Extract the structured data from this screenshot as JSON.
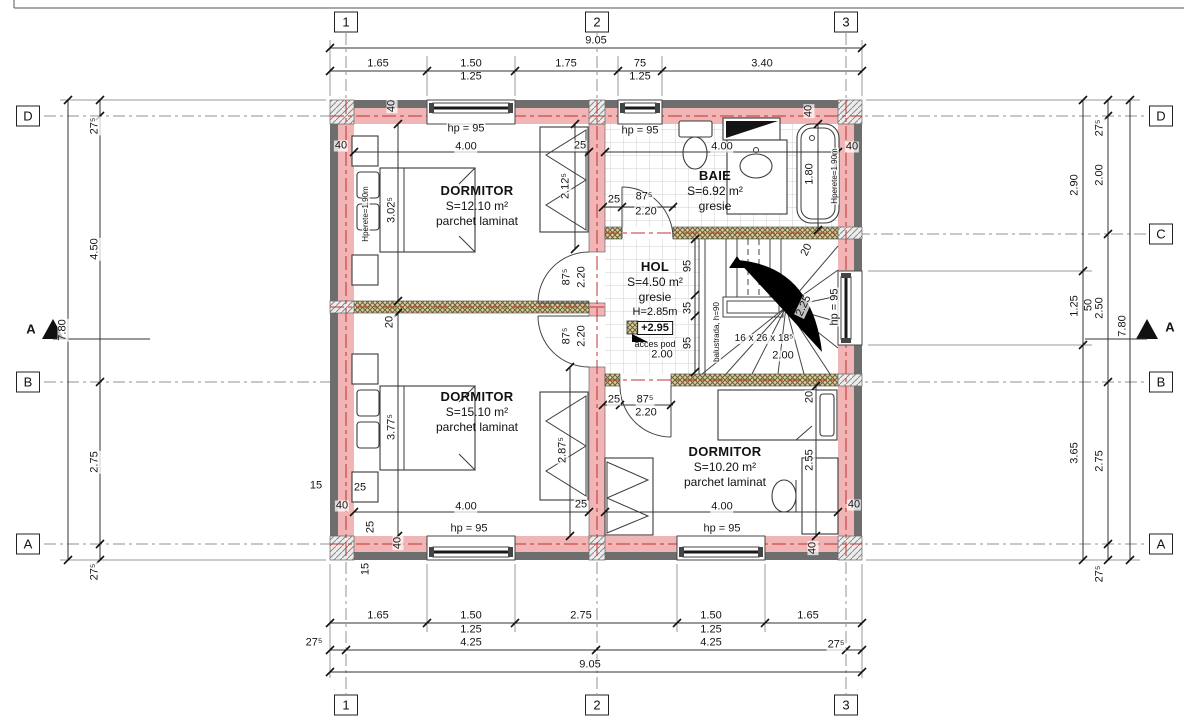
{
  "colors": {
    "wall_pink": "#f2b5b5",
    "wall_gray": "#6e6e6e",
    "axis_red": "#c03030",
    "hatch_bg": "#d8cf9f",
    "hatch_line": "#6b6136"
  },
  "rooms": [
    {
      "name": "DORMITOR",
      "area": "S=12.10 m²",
      "finish": "parchet laminat"
    },
    {
      "name": "BAIE",
      "area": "S=6.92 m²",
      "finish": "gresie"
    },
    {
      "name": "HOL",
      "area": "S=4.50 m²",
      "finish": "gresie",
      "height": "H=2.85m",
      "level": "+2.95",
      "note": "acces pod"
    },
    {
      "name": "DORMITOR",
      "area": "S=15.10 m²",
      "finish": "parchet laminat"
    },
    {
      "name": "DORMITOR",
      "area": "S=10.20 m²",
      "finish": "parchet laminat"
    }
  ],
  "grid": {
    "bubbles": [
      {
        "label": "1",
        "x": 346,
        "y": 22
      },
      {
        "label": "2",
        "x": 597,
        "y": 22
      },
      {
        "label": "3",
        "x": 846,
        "y": 22
      },
      {
        "label": "1",
        "x": 346,
        "y": 705
      },
      {
        "label": "2",
        "x": 597,
        "y": 705
      },
      {
        "label": "3",
        "x": 846,
        "y": 705
      },
      {
        "label": "D",
        "x": 28,
        "y": 116
      },
      {
        "label": "B",
        "x": 28,
        "y": 382
      },
      {
        "label": "A",
        "x": 28,
        "y": 544
      },
      {
        "label": "D",
        "x": 1161,
        "y": 116
      },
      {
        "label": "C",
        "x": 1161,
        "y": 234
      },
      {
        "label": "B",
        "x": 1161,
        "y": 382
      },
      {
        "label": "A",
        "x": 1161,
        "y": 544
      }
    ]
  },
  "dims": [
    {
      "t": "9.05",
      "x": 596,
      "y": 41
    },
    {
      "t": "1.65",
      "x": 378,
      "y": 64
    },
    {
      "t": "1.50",
      "x": 471,
      "y": 64
    },
    {
      "t": "1.25",
      "x": 471,
      "y": 77
    },
    {
      "t": "1.75",
      "x": 566,
      "y": 64
    },
    {
      "t": "75",
      "x": 640,
      "y": 64
    },
    {
      "t": "1.25",
      "x": 640,
      "y": 77
    },
    {
      "t": "3.40",
      "x": 762,
      "y": 64
    },
    {
      "t": "1.65",
      "x": 378,
      "y": 616
    },
    {
      "t": "1.50",
      "x": 471,
      "y": 616
    },
    {
      "t": "1.25",
      "x": 471,
      "y": 630
    },
    {
      "t": "2.75",
      "x": 581,
      "y": 616
    },
    {
      "t": "1.50",
      "x": 711,
      "y": 616
    },
    {
      "t": "1.25",
      "x": 711,
      "y": 630
    },
    {
      "t": "1.65",
      "x": 808,
      "y": 616
    },
    {
      "t": "27⁵",
      "x": 314,
      "y": 643
    },
    {
      "t": "4.25",
      "x": 471,
      "y": 643
    },
    {
      "t": "4.25",
      "x": 711,
      "y": 643
    },
    {
      "t": "27⁵",
      "x": 836,
      "y": 645
    },
    {
      "t": "9.05",
      "x": 590,
      "y": 665
    },
    {
      "t": "7.80",
      "x": 63,
      "y": 330,
      "r": -90
    },
    {
      "t": "27⁵",
      "x": 95,
      "y": 126,
      "r": -90
    },
    {
      "t": "4.50",
      "x": 95,
      "y": 249,
      "r": -90
    },
    {
      "t": "2.75",
      "x": 95,
      "y": 462,
      "r": -90
    },
    {
      "t": "27⁵",
      "x": 95,
      "y": 572,
      "r": -90
    },
    {
      "t": "A",
      "x": 31,
      "y": 329,
      "b": 1,
      "n": "section-marker-label"
    },
    {
      "t": "27⁵",
      "x": 1100,
      "y": 128,
      "r": -90
    },
    {
      "t": "2.00",
      "x": 1100,
      "y": 175,
      "r": -90
    },
    {
      "t": "2.90",
      "x": 1075,
      "y": 185,
      "r": -90
    },
    {
      "t": "1.25",
      "x": 1075,
      "y": 306,
      "r": -90
    },
    {
      "t": "50",
      "x": 1089,
      "y": 305,
      "r": -90
    },
    {
      "t": "2.50",
      "x": 1100,
      "y": 308,
      "r": -90
    },
    {
      "t": "7.80",
      "x": 1123,
      "y": 326,
      "r": -90
    },
    {
      "t": "3.65",
      "x": 1075,
      "y": 453,
      "r": -90
    },
    {
      "t": "2.75",
      "x": 1100,
      "y": 461,
      "r": -90
    },
    {
      "t": "27⁵",
      "x": 1100,
      "y": 574,
      "r": -90
    },
    {
      "t": "A",
      "x": 1170,
      "y": 327,
      "b": 1,
      "n": "section-marker-label"
    },
    {
      "t": "hp = 95",
      "x": 466,
      "y": 129
    },
    {
      "t": "4.00",
      "x": 466,
      "y": 147
    },
    {
      "t": "40",
      "x": 341,
      "y": 146
    },
    {
      "t": "40",
      "x": 392,
      "y": 106,
      "r": -90
    },
    {
      "t": "25",
      "x": 580,
      "y": 146
    },
    {
      "t": "3.02⁵",
      "x": 392,
      "y": 210,
      "r": -90
    },
    {
      "t": "2.12⁵",
      "x": 566,
      "y": 186,
      "r": -90
    },
    {
      "t": "Hperete=1.90m",
      "x": 366,
      "y": 214,
      "r": -90,
      "s": 8
    },
    {
      "t": "20",
      "x": 390,
      "y": 322,
      "r": -90
    },
    {
      "t": "hp = 95",
      "x": 640,
      "y": 131
    },
    {
      "t": "4.00",
      "x": 722,
      "y": 147
    },
    {
      "t": "40",
      "x": 852,
      "y": 147
    },
    {
      "t": "40",
      "x": 809,
      "y": 111,
      "r": -90
    },
    {
      "t": "1.80",
      "x": 810,
      "y": 174,
      "r": -90
    },
    {
      "t": "Hperete=1.90m",
      "x": 835,
      "y": 176,
      "r": -90,
      "s": 8
    },
    {
      "t": "25",
      "x": 614,
      "y": 200
    },
    {
      "t": "87⁵",
      "x": 644,
      "y": 197
    },
    {
      "t": "2.20",
      "x": 646,
      "y": 212
    },
    {
      "t": "87⁵",
      "x": 567,
      "y": 277,
      "r": -90
    },
    {
      "t": "2.20",
      "x": 582,
      "y": 277,
      "r": -90
    },
    {
      "t": "87⁵",
      "x": 567,
      "y": 336,
      "r": -90
    },
    {
      "t": "2.20",
      "x": 582,
      "y": 336,
      "r": -90
    },
    {
      "t": "95",
      "x": 688,
      "y": 266,
      "r": -90
    },
    {
      "t": "35",
      "x": 688,
      "y": 308,
      "r": -90
    },
    {
      "t": "95",
      "x": 688,
      "y": 343,
      "r": -90
    },
    {
      "t": "2.00",
      "x": 662,
      "y": 355
    },
    {
      "t": "balustrada, h=90",
      "x": 717,
      "y": 332,
      "r": -90,
      "s": 8,
      "n": "stair-balustrade-label"
    },
    {
      "t": "16 x 26 x 18⁵",
      "x": 764,
      "y": 339,
      "s": 10,
      "n": "stair-formula"
    },
    {
      "t": "2.00",
      "x": 783,
      "y": 356
    },
    {
      "t": "2.25",
      "x": 804,
      "y": 306,
      "r": -65
    },
    {
      "t": "20",
      "x": 807,
      "y": 250,
      "r": -65
    },
    {
      "t": "hp = 95",
      "x": 835,
      "y": 307,
      "r": -90
    },
    {
      "t": "20",
      "x": 810,
      "y": 397,
      "r": -90
    },
    {
      "t": "2.55",
      "x": 810,
      "y": 460,
      "r": -90
    },
    {
      "t": "4.00",
      "x": 722,
      "y": 507
    },
    {
      "t": "hp = 95",
      "x": 722,
      "y": 529
    },
    {
      "t": "40",
      "x": 854,
      "y": 505
    },
    {
      "t": "40",
      "x": 813,
      "y": 548,
      "r": -90
    },
    {
      "t": "25",
      "x": 614,
      "y": 400
    },
    {
      "t": "87⁵",
      "x": 645,
      "y": 400
    },
    {
      "t": "2.20",
      "x": 646,
      "y": 413
    },
    {
      "t": "3.77⁵",
      "x": 392,
      "y": 427,
      "r": -90
    },
    {
      "t": "2.87⁵",
      "x": 563,
      "y": 450,
      "r": -90
    },
    {
      "t": "4.00",
      "x": 466,
      "y": 507
    },
    {
      "t": "hp = 95",
      "x": 469,
      "y": 529
    },
    {
      "t": "25",
      "x": 360,
      "y": 488
    },
    {
      "t": "15",
      "x": 316,
      "y": 486
    },
    {
      "t": "25",
      "x": 581,
      "y": 505
    },
    {
      "t": "40",
      "x": 342,
      "y": 506
    },
    {
      "t": "25",
      "x": 371,
      "y": 527,
      "r": -90
    },
    {
      "t": "40",
      "x": 398,
      "y": 543,
      "r": -90
    },
    {
      "t": "15",
      "x": 366,
      "y": 569,
      "r": -90
    }
  ]
}
